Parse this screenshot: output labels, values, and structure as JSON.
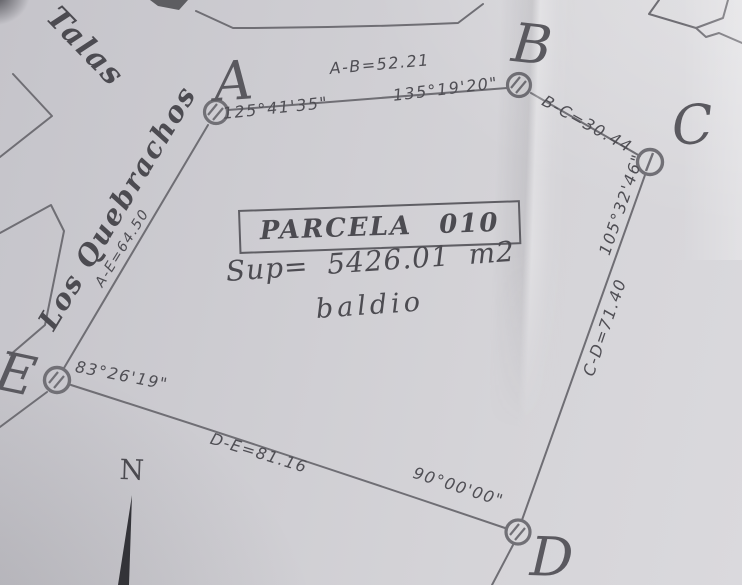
{
  "title_block": {
    "parcel_label": "PARCELA 010",
    "surface_label": "Sup= 5426.01 m2",
    "land_status": "baldio"
  },
  "streets": {
    "top": "Talas",
    "west": "Los Quebrachos"
  },
  "vertices": {
    "a": "A",
    "b": "B",
    "c": "C",
    "d": "D",
    "e": "E"
  },
  "side_lengths": {
    "ab": "A-B=52.21",
    "bc": "B-C=30.44",
    "cd": "C-D=71.40",
    "de": "D-E=81.16",
    "ae": "A-E=64.50"
  },
  "interior_angles": {
    "a": "125°41'35\"",
    "b": "135°19'20\"",
    "c": "105°32'46\"",
    "d": "90°00'00\"",
    "e": "83°26'19\""
  },
  "north_label": "N",
  "colors": {
    "paper": "#d0cfd4",
    "ink": "#4c4b51",
    "linework": "#6f6e74"
  }
}
